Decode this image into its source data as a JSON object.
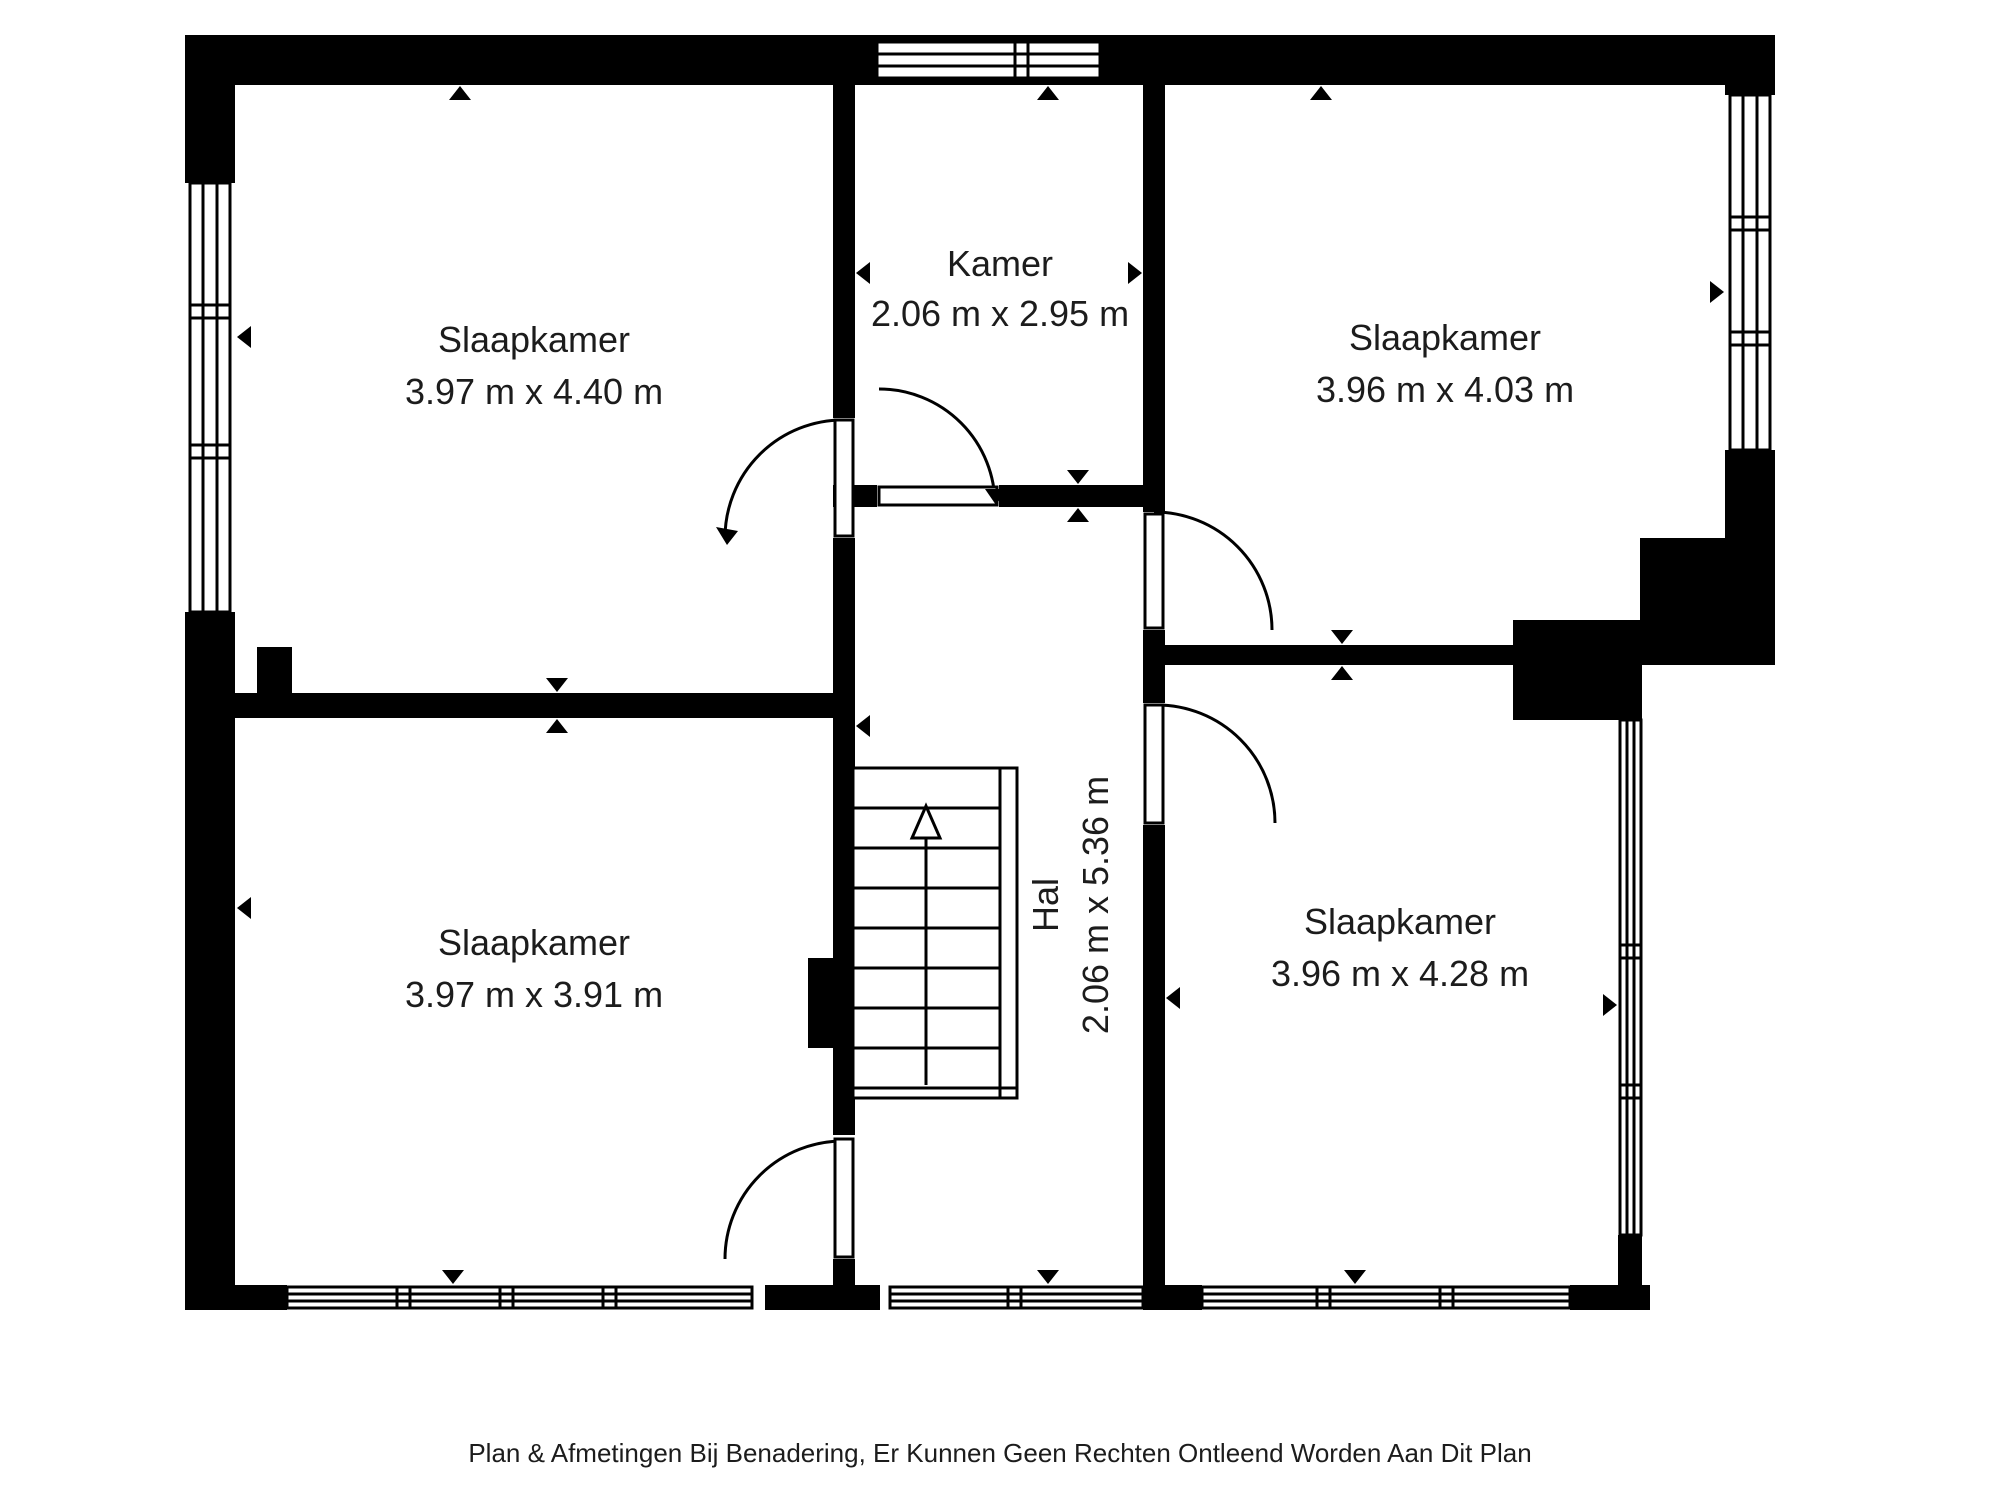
{
  "plan": {
    "rooms": [
      {
        "id": "slaapkamer-top-left",
        "name": "Slaapkamer",
        "dims": "3.97 m x 4.40 m"
      },
      {
        "id": "kamer",
        "name": "Kamer",
        "dims": "2.06 m x 2.95 m"
      },
      {
        "id": "slaapkamer-top-right",
        "name": "Slaapkamer",
        "dims": "3.96 m x 4.03 m"
      },
      {
        "id": "slaapkamer-bottom-left",
        "name": "Slaapkamer",
        "dims": "3.97 m x 3.91 m"
      },
      {
        "id": "hal",
        "name": "Hal",
        "dims": "2.06 m x 5.36 m"
      },
      {
        "id": "slaapkamer-bottom-right",
        "name": "Slaapkamer",
        "dims": "3.96 m x 4.28 m"
      }
    ],
    "stairs": {
      "icon": "stairs-up-arrow",
      "treads": 8
    },
    "icons": [
      "window-icon",
      "door-swing-icon",
      "dimension-arrow-icon"
    ],
    "caption": "Plan & Afmetingen Bij Benadering, Er Kunnen Geen Rechten Ontleend Worden Aan Dit Plan",
    "colors": {
      "wall": "#000000",
      "text": "#1c1c1c",
      "background": "#ffffff"
    }
  }
}
